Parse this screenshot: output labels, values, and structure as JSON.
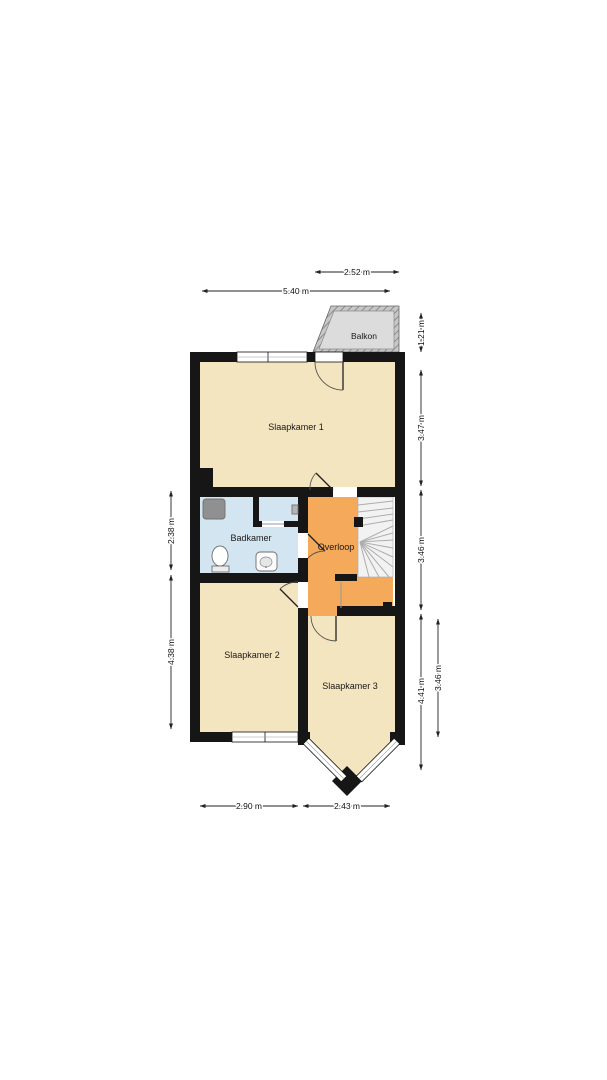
{
  "floor_plan": {
    "rooms": [
      {
        "name": "Slaapkamer 1"
      },
      {
        "name": "Badkamer"
      },
      {
        "name": "Overloop"
      },
      {
        "name": "Slaapkamer 2"
      },
      {
        "name": "Slaapkamer 3"
      },
      {
        "name": "Balkon"
      }
    ],
    "dimensions": {
      "top": [
        "2.52 m",
        "5.40 m"
      ],
      "right": [
        "1.21 m",
        "3.47 m",
        "3.46 m",
        "4.41 m",
        "3.46 m"
      ],
      "left": [
        "2.38 m",
        "4.38 m"
      ],
      "bottom": [
        "2.90 m",
        "2.43 m"
      ]
    },
    "colors": {
      "wall": "#161616",
      "bedroom_fill": "#f3e5bf",
      "bathroom_fill": "#d2e5f1",
      "landing_fill": "#f4a95b",
      "balcony_fill": "#dcdcdc",
      "stairs_fill": "#f2f2f2"
    }
  }
}
